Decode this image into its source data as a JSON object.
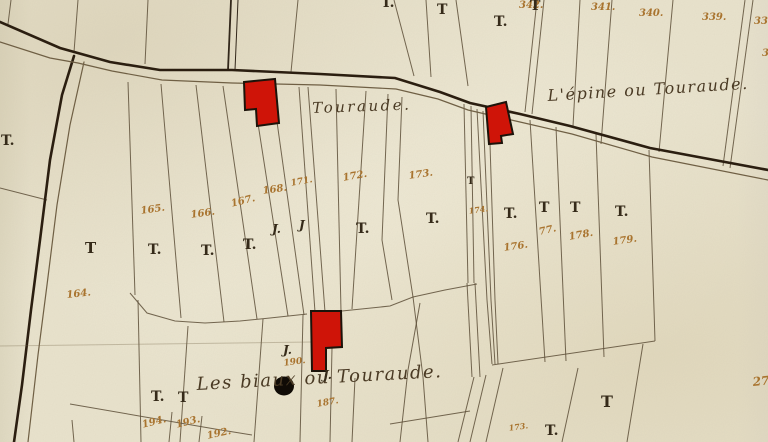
{
  "map": {
    "title": "cadastral map sheet — Touraude",
    "colors": {
      "paper": "#e9e3cd",
      "boundary_ink": "#5d4f38",
      "dark_ink": "#32271a",
      "road_ink": "#2b1e10",
      "road_edge_ink": "#6f5f44",
      "number_ink": "#a9742f",
      "mark_ink": "#352a19",
      "building_red": "#cf1408",
      "building_outline": "#1c130a",
      "blot_black": "#100b06",
      "crease": "#786a4e"
    },
    "roads": [
      {
        "k": "road",
        "points": "0,22 60,48 110,62 160,70 232,70 320,74 395,78 440,92 470,103 520,114 570,126 650,148 768,170"
      },
      {
        "k": "road",
        "points": "74,56 62,95 50,160 40,240 31,310 22,385 14,442"
      },
      {
        "k": "edge",
        "points": "0,42 50,58 78,63 112,71 162,80 232,83 320,85 396,89 438,99 468,110 520,122 572,134 652,157 768,180"
      },
      {
        "k": "edge",
        "points": "84,62 70,125 57,205 47,285 38,355 28,442"
      }
    ],
    "dark_boundaries": [
      {
        "points": "231,0 228,70"
      },
      {
        "points": "238,0 235,70"
      }
    ],
    "boundaries": [
      {
        "points": "11,0 8,24"
      },
      {
        "points": "78,0 74,52"
      },
      {
        "points": "148,0 145,64"
      },
      {
        "points": "298,0 291,72"
      },
      {
        "points": "394,0 414,76"
      },
      {
        "points": "426,0 431,77"
      },
      {
        "points": "456,0 468,86"
      },
      {
        "points": "537,0 525,112"
      },
      {
        "points": "544,0 532,114"
      },
      {
        "points": "580,0 573,126"
      },
      {
        "points": "612,0 601,144"
      },
      {
        "points": "673,0 659,152"
      },
      {
        "points": "745,0 723,166"
      },
      {
        "points": "753,0 730,168"
      },
      {
        "points": "0,188 47,200"
      },
      {
        "points": "128,82 135,295"
      },
      {
        "points": "161,84 181,318"
      },
      {
        "points": "196,85 224,322"
      },
      {
        "points": "223,86 257,319"
      },
      {
        "points": "252,85 288,316"
      },
      {
        "points": "272,86 304,315"
      },
      {
        "points": "299,87 315,312"
      },
      {
        "points": "308,87 325,312"
      },
      {
        "points": "336,89 341,311"
      },
      {
        "points": "366,91 352,309"
      },
      {
        "points": "388,94 382,240 392,300"
      },
      {
        "points": "402,97 398,200 413,297 423,377 428,442"
      },
      {
        "points": "464,104 468,283"
      },
      {
        "points": "471,106 474,283"
      },
      {
        "points": "467,283 472,377"
      },
      {
        "points": "475,283 480,377"
      },
      {
        "points": "477,109 487,300 492,364"
      },
      {
        "points": "483,111 491,300 495,364"
      },
      {
        "points": "489,113 495,300 498,364"
      },
      {
        "points": "530,120 545,362"
      },
      {
        "points": "556,127 566,361"
      },
      {
        "points": "596,134 604,357"
      },
      {
        "points": "649,150 655,341"
      },
      {
        "points": "492,365 655,341"
      },
      {
        "points": "578,368 562,442"
      },
      {
        "points": "643,344 627,442"
      },
      {
        "points": "474,377 458,442"
      },
      {
        "points": "486,375 470,442"
      },
      {
        "points": "503,368 486,442"
      },
      {
        "points": "130,293 147,313 175,321 205,323 240,321 270,318 307,314"
      },
      {
        "points": "342,311 390,306 413,297 445,290 477,284"
      },
      {
        "points": "188,326 180,442"
      },
      {
        "points": "263,319 254,442"
      },
      {
        "points": "303,315 300,442"
      },
      {
        "points": "332,348 330,442"
      },
      {
        "points": "355,378 352,442"
      },
      {
        "points": "420,303 408,370 400,442"
      },
      {
        "points": "390,424 470,411"
      },
      {
        "points": "138,300 141,442"
      },
      {
        "points": "70,404 145,417 215,429 252,435"
      },
      {
        "points": "172,412 169,442"
      },
      {
        "points": "202,416 199,442"
      },
      {
        "points": "72,420 74,442"
      }
    ],
    "crease": {
      "points": "0,346 312,342"
    },
    "buildings": [
      {
        "points": "244,82 275,79 279,123 257,126 256,109 245,110"
      },
      {
        "points": "486,107 506,102 513,134 501,136 502,143 489,144"
      },
      {
        "points": "311,311 341,311 342,347 326,348 326,371 312,371"
      }
    ],
    "ink_blot": {
      "cx": 284,
      "cy": 386,
      "rx": 10,
      "ry": 9.5
    },
    "region_labels": [
      {
        "text": "Touraude.",
        "x": 312,
        "y": 99,
        "size": 15,
        "rot": -2,
        "ls": 2.5
      },
      {
        "text": "L'épine ou Touraude.",
        "x": 547,
        "y": 86,
        "size": 16,
        "rot": -3.5,
        "ls": 1.5
      },
      {
        "text": "Les biaux ou Touraude.",
        "x": 196,
        "y": 374,
        "size": 18,
        "rot": -3,
        "ls": 1.5
      }
    ],
    "parcel_numbers": [
      {
        "text": "342.",
        "x": 519,
        "y": 0,
        "size": 10,
        "rot": 0
      },
      {
        "text": "341.",
        "x": 591,
        "y": 2,
        "size": 10,
        "rot": 0
      },
      {
        "text": "340.",
        "x": 639,
        "y": 8,
        "size": 10,
        "rot": 0
      },
      {
        "text": "339.",
        "x": 702,
        "y": 12,
        "size": 10,
        "rot": 0
      },
      {
        "text": "338.",
        "x": 754,
        "y": 16,
        "size": 10,
        "rot": 0
      },
      {
        "text": "3",
        "x": 762,
        "y": 48,
        "size": 10,
        "rot": 0
      },
      {
        "text": "165.",
        "x": 140,
        "y": 206,
        "size": 10,
        "rot": -8
      },
      {
        "text": "166.",
        "x": 190,
        "y": 210,
        "size": 10,
        "rot": -8
      },
      {
        "text": "167.",
        "x": 230,
        "y": 199,
        "size": 10,
        "rot": -14
      },
      {
        "text": "168.",
        "x": 262,
        "y": 186,
        "size": 10,
        "rot": -8
      },
      {
        "text": "171.",
        "x": 290,
        "y": 179,
        "size": 9,
        "rot": -10
      },
      {
        "text": "172.",
        "x": 342,
        "y": 173,
        "size": 10,
        "rot": -10
      },
      {
        "text": "173.",
        "x": 408,
        "y": 171,
        "size": 10,
        "rot": -8
      },
      {
        "text": "174.",
        "x": 468,
        "y": 206,
        "size": 8,
        "rot": -8
      },
      {
        "text": "176.",
        "x": 503,
        "y": 243,
        "size": 10,
        "rot": -8
      },
      {
        "text": "77.",
        "x": 538,
        "y": 227,
        "size": 10,
        "rot": -12
      },
      {
        "text": "178.",
        "x": 568,
        "y": 232,
        "size": 10,
        "rot": -10
      },
      {
        "text": "179.",
        "x": 612,
        "y": 237,
        "size": 10,
        "rot": -8
      },
      {
        "text": "164.",
        "x": 66,
        "y": 290,
        "size": 10,
        "rot": -6
      },
      {
        "text": "190.",
        "x": 283,
        "y": 359,
        "size": 9,
        "rot": -8
      },
      {
        "text": "187.",
        "x": 316,
        "y": 400,
        "size": 9,
        "rot": -10
      },
      {
        "text": "194.",
        "x": 141,
        "y": 420,
        "size": 10,
        "rot": -14
      },
      {
        "text": "193.",
        "x": 175,
        "y": 420,
        "size": 10,
        "rot": -14
      },
      {
        "text": "192.",
        "x": 206,
        "y": 431,
        "size": 10,
        "rot": -12
      },
      {
        "text": "173.",
        "x": 508,
        "y": 423,
        "size": 8,
        "rot": -8
      },
      {
        "text": "27",
        "x": 752,
        "y": 375,
        "size": 12,
        "rot": -6
      }
    ],
    "t_marks": [
      {
        "text": "T.",
        "x": 1,
        "y": 133,
        "size": 14
      },
      {
        "text": "T.",
        "x": 381,
        "y": -5,
        "size": 14
      },
      {
        "text": "T",
        "x": 437,
        "y": 2,
        "size": 14
      },
      {
        "text": "T.",
        "x": 494,
        "y": 14,
        "size": 14
      },
      {
        "text": "T",
        "x": 530,
        "y": -2,
        "size": 14
      },
      {
        "text": "T",
        "x": 85,
        "y": 239,
        "size": 15
      },
      {
        "text": "T.",
        "x": 148,
        "y": 242,
        "size": 14
      },
      {
        "text": "T.",
        "x": 201,
        "y": 243,
        "size": 14
      },
      {
        "text": "T.",
        "x": 243,
        "y": 237,
        "size": 14
      },
      {
        "text": "T.",
        "x": 356,
        "y": 221,
        "size": 14
      },
      {
        "text": "T.",
        "x": 426,
        "y": 211,
        "size": 14
      },
      {
        "text": "T",
        "x": 467,
        "y": 176,
        "size": 10
      },
      {
        "text": "T.",
        "x": 504,
        "y": 206,
        "size": 14
      },
      {
        "text": "T",
        "x": 539,
        "y": 200,
        "size": 14
      },
      {
        "text": "T",
        "x": 570,
        "y": 200,
        "size": 14
      },
      {
        "text": "T.",
        "x": 615,
        "y": 204,
        "size": 14
      },
      {
        "text": "T.",
        "x": 151,
        "y": 389,
        "size": 14
      },
      {
        "text": "T",
        "x": 178,
        "y": 390,
        "size": 14
      },
      {
        "text": "T.",
        "x": 545,
        "y": 423,
        "size": 14
      },
      {
        "text": "T",
        "x": 601,
        "y": 392,
        "size": 16
      }
    ],
    "j_marks": [
      {
        "text": "J.",
        "x": 272,
        "y": 222,
        "size": 12
      },
      {
        "text": "J",
        "x": 299,
        "y": 218,
        "size": 12
      },
      {
        "text": "J.",
        "x": 283,
        "y": 343,
        "size": 12
      },
      {
        "text": "J.",
        "x": 323,
        "y": 368,
        "size": 12
      }
    ]
  }
}
